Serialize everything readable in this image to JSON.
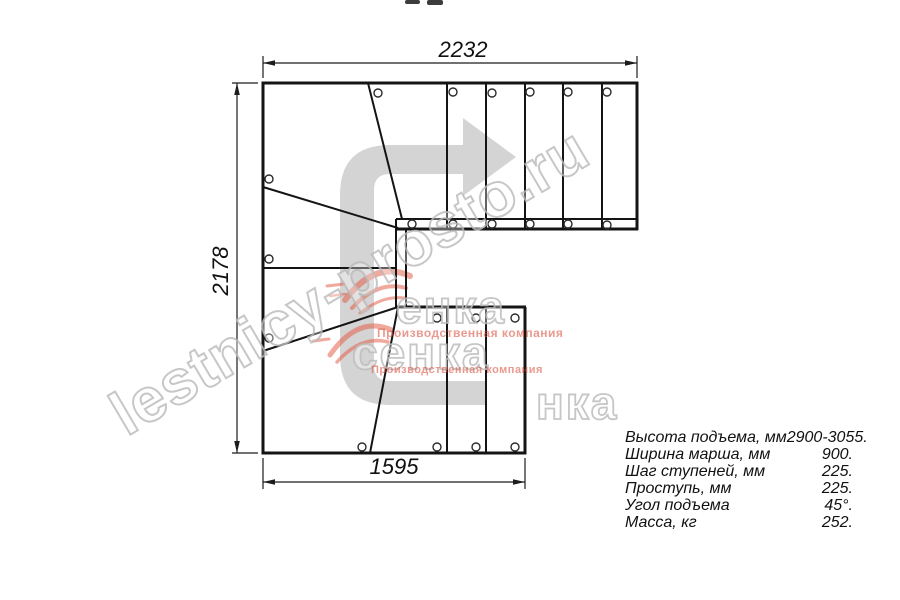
{
  "drawing": {
    "dimensions": {
      "top": "2232",
      "left": "2178",
      "bottom": "1595"
    },
    "specs": {
      "rows": [
        {
          "label": "Высота подъема, мм",
          "value": "2900-3055."
        },
        {
          "label": "Ширина марша, мм",
          "value": "900."
        },
        {
          "label": "Шаг ступеней, мм",
          "value": "225."
        },
        {
          "label": "Проступь, мм",
          "value": "225."
        },
        {
          "label": "Угол подъема",
          "value": "45°."
        },
        {
          "label": "Масса, кг",
          "value": "252."
        }
      ]
    },
    "watermark": {
      "diagonal_text": "lestnicy-prosto.ru",
      "logo_fragment_a": "енка",
      "logo_fragment_b": "сенка",
      "logo_fragment_c": "нка",
      "tagline": "Производственная компания"
    },
    "colors": {
      "line": "#141414",
      "arrow_gray": "#d4d4d4",
      "watermark_gray": "#bababa",
      "tagline_red": "#dd5a48"
    }
  }
}
